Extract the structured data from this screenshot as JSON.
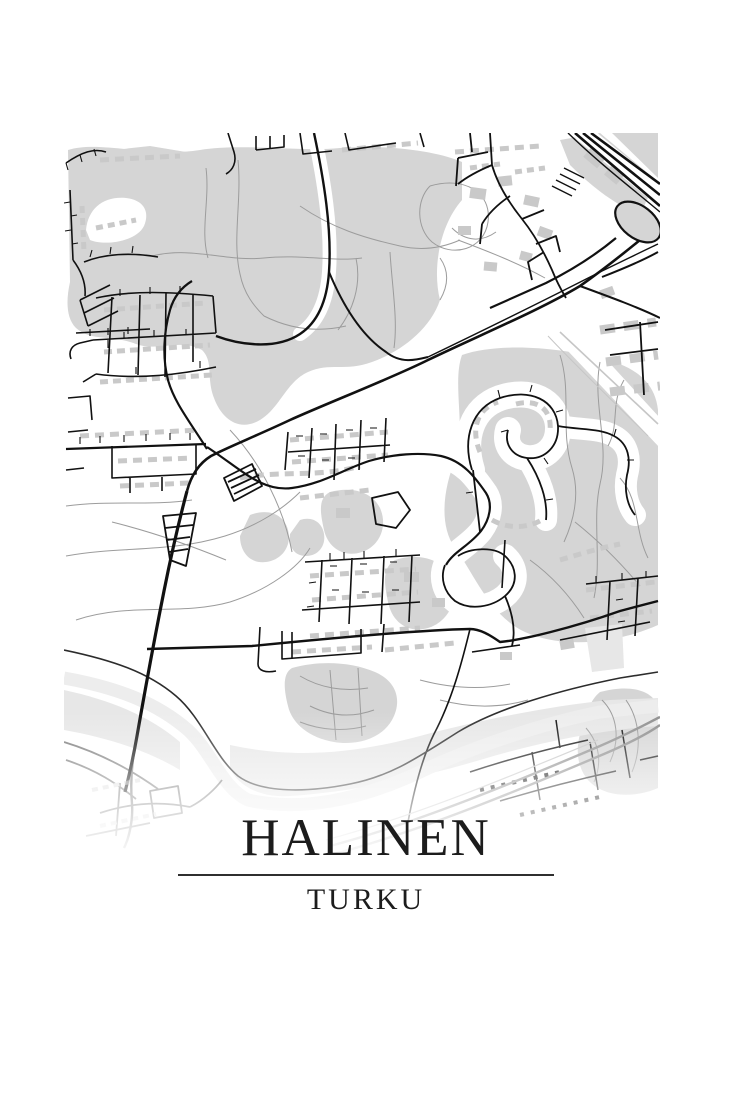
{
  "poster": {
    "title": "HALINEN",
    "subtitle": "TURKU"
  },
  "colors": {
    "bg": "#ffffff",
    "landuse": "#d5d5d5",
    "landuse-light": "#e7e7e7",
    "building": "#c9c9c9",
    "road": "#111111",
    "path": "#9c9c9c",
    "river": "#ededed",
    "railway": "#8f8f8f",
    "text": "#1c1c1c"
  }
}
